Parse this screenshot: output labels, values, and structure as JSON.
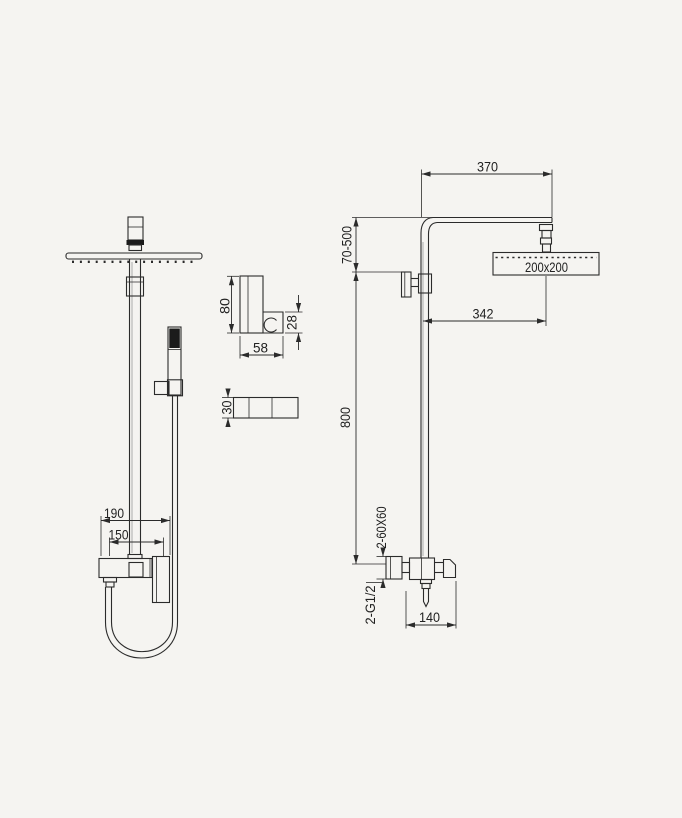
{
  "drawing": {
    "title": "shower-column-technical-drawing",
    "front_view": {
      "dim_valve_total_width": "190",
      "dim_valve_inner_width": "150"
    },
    "holder_detail": {
      "dim_height": "80",
      "dim_hook_height": "28",
      "dim_width": "58"
    },
    "slider_detail": {
      "dim_height": "30"
    },
    "side_view": {
      "dim_arm_length": "370",
      "dim_top_adjust_range": "70-500",
      "head_size_label": "200x200",
      "dim_head_offset": "342",
      "dim_riser_height": "800",
      "wall_plate_label": "2-60X60",
      "connection_label": "2-G1/2",
      "dim_valve_depth": "140"
    },
    "colors": {
      "background": "#f5f4f1",
      "line": "#2b2b2b"
    }
  }
}
